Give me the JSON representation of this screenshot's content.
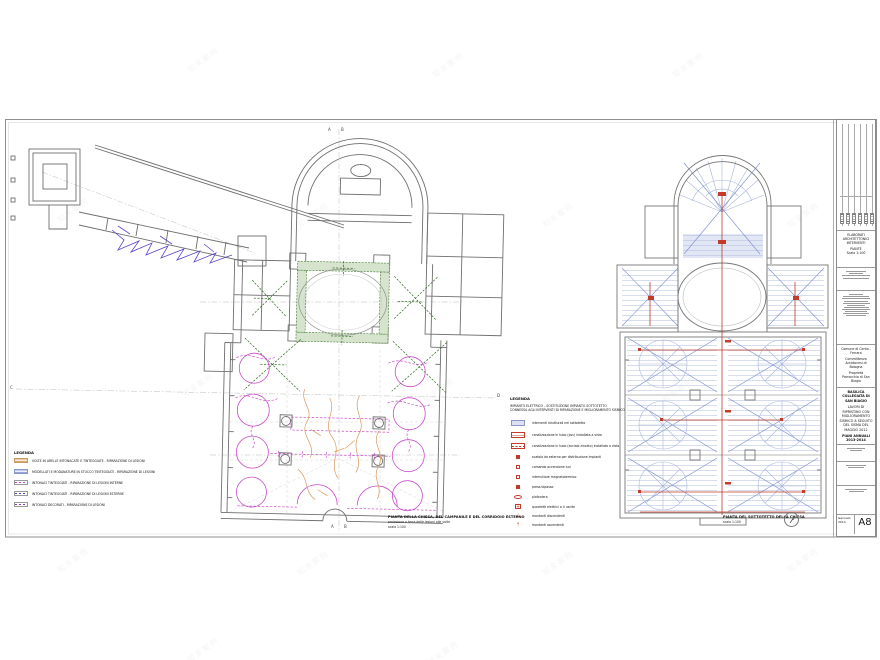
{
  "watermark": "知末案例",
  "markers": {
    "top_a": "A",
    "top_b": "B",
    "bottom_a": "A",
    "bottom_b": "B",
    "left": "C",
    "right": "D"
  },
  "captions": {
    "left_title": "PIANTA DELLA CHIESA, DEL CAMPANILE E DEL CORRIDOIO ESTERNO",
    "left_sub": "proiezione a terra delle lesioni alle volte",
    "left_scale": "scala 1:100",
    "right_title": "PIANTA DEL SOTTOTETTO DELLA CHIESA",
    "right_scale": "scala 1:100"
  },
  "legend_left": {
    "title": "LEGENDA",
    "items": [
      {
        "label": "VOLTE IN ARELLE INTONACATE E TINTEGGIATE - RIPARAZIONE DI LESIONI"
      },
      {
        "label": "MODELLATI E MODANATURE IN STUCCO TINTEGGIATI - RIPARAZIONE DI LESIONI"
      },
      {
        "label": "INTONACI TINTEGGIATI - RIPARAZIONE DI LESIONI INTERNE"
      },
      {
        "label": "INTONACI TINTEGGIATI - RIPARAZIONE DI LESIONI ESTERNE"
      },
      {
        "label": "INTONACI DECORATI - RIPARAZIONE DI LESIONI"
      }
    ]
  },
  "legend_electric": {
    "title": "LEGENDA",
    "subtitle_1": "IMPIANTO ELETTRICO - SOSTITUZIONE IMPIANTO SOTTOTETTO",
    "subtitle_2": "CONNESSA AGLI INTERVENTI DI RIPARAZIONE E MIGLIORAMENTO SISMICO",
    "items": [
      {
        "label": "interventi strutturali nel sottotetto"
      },
      {
        "label": "canalizzazione in tubo (pvc) installata a vista"
      },
      {
        "label": "canalizzazione in tubo (acciaio zincato) installata a vista"
      },
      {
        "label": "scatola da esterno per distribuzione impianti"
      },
      {
        "label": "comando accensione luci"
      },
      {
        "label": "interruttore magnetotermico"
      },
      {
        "label": "presa bipasso"
      },
      {
        "label": "plafoniera"
      },
      {
        "label": "quadretti elettrici a 4 uscite"
      },
      {
        "label": "montanti discendenti"
      },
      {
        "label": "montanti ascendenti"
      }
    ]
  },
  "titleblock": {
    "doc_type_1": "ELABORATI ARCHITETTONICI",
    "doc_type_2": "INTERVENTI",
    "doc_name": "PIANTE",
    "doc_scale": "Scala 1:100",
    "comune": "Comune di Cento - Ferrara",
    "committenza_label": "Committenza",
    "committenza": "Arcidiocesi di Bologna",
    "proprieta_label": "Proprietà",
    "proprieta": "Parrocchia di San Biagio",
    "project_1": "BASILICA COLLEGIATA DI SAN BIAGIO",
    "project_2": "LAVORI DI RIPRISTINO CON MIGLIORAMENTO SISMICO A SEGUITO DEL SISMA DEL MAGGIO 2012",
    "project_3": "PIANI ANNUALI 2013-2014",
    "date": "Gennaio 2014",
    "sheet_code": "A8"
  },
  "colors": {
    "wall": "#6f6f6f",
    "green_fill": "#d6e4cd",
    "green_line": "#3c7a2a",
    "magenta": "#c84ec8",
    "orange": "#d9985c",
    "violet": "#5b45c9",
    "lightblue": "#a9b7dc",
    "blue": "#7d8fd0",
    "red": "#c23b2a"
  }
}
